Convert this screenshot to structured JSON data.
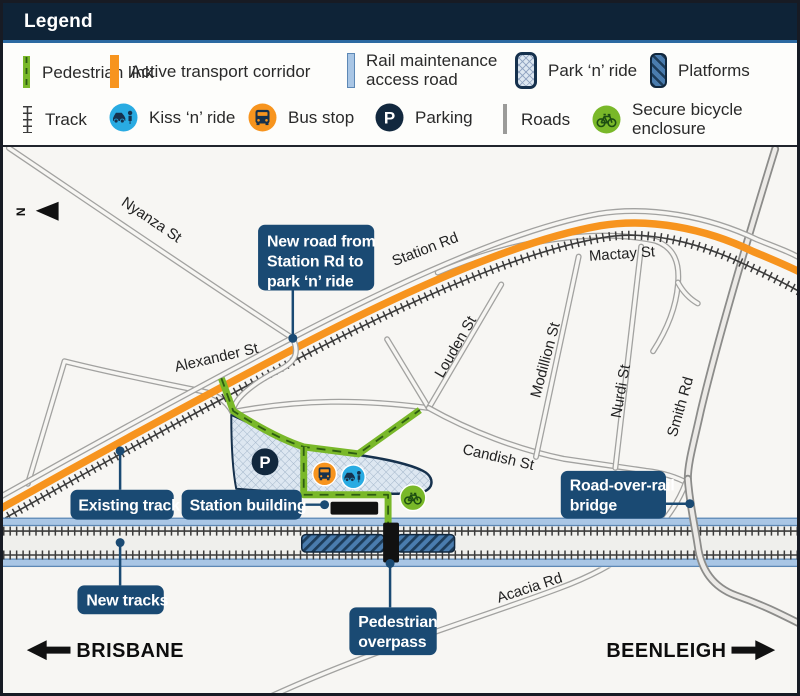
{
  "legend": {
    "title": "Legend",
    "row1": [
      {
        "icon": "pedestrian-link-swatch",
        "label": "Pedestrian link"
      },
      {
        "icon": "active-transport-corridor-swatch",
        "label": "Active transport corridor"
      },
      {
        "icon": "rail-maintenance-road-swatch",
        "lines": [
          "Rail maintenance",
          "access road"
        ]
      },
      {
        "icon": "park-n-ride-swatch",
        "label": "Park ‘n’ ride"
      },
      {
        "icon": "platforms-swatch",
        "label": "Platforms"
      }
    ],
    "row2": [
      {
        "icon": "track-glyph",
        "label": "Track"
      },
      {
        "icon": "kiss-n-ride-icon",
        "label": "Kiss ‘n’ ride"
      },
      {
        "icon": "bus-stop-icon",
        "label": "Bus stop"
      },
      {
        "icon": "parking-icon",
        "label": "Parking"
      },
      {
        "icon": "roads-glyph",
        "label": "Roads"
      },
      {
        "icon": "bicycle-icon",
        "lines": [
          "Secure bicycle",
          "enclosure"
        ]
      }
    ]
  },
  "map": {
    "north_label": "N",
    "parking_symbol": "P",
    "streets": {
      "nyanza": "Nyanza St",
      "alexander": "Alexander St",
      "station_rd": "Station Rd",
      "mactay": "Mactay St",
      "louden": "Louden St",
      "modillion": "Modillion St",
      "nurdi": "Nurdi St",
      "smith": "Smith Rd",
      "candish": "Candish St",
      "acacia": "Acacia Rd"
    },
    "callouts": {
      "new_road": {
        "lines": [
          "New road from",
          "Station Rd to",
          "park ‘n’ ride"
        ]
      },
      "existing_track": {
        "lines": [
          "Existing track"
        ]
      },
      "station_building": {
        "lines": [
          "Station building"
        ]
      },
      "new_tracks": {
        "lines": [
          "New tracks"
        ]
      },
      "pedestrian_overpass": {
        "lines": [
          "Pedestrian",
          "overpass"
        ]
      },
      "road_over_rail": {
        "lines": [
          "Road-over-rail",
          "bridge"
        ]
      }
    },
    "directions": {
      "west": "BRISBANE",
      "east": "BEENLEIGH"
    }
  },
  "colors": {
    "header_navy": "#0e2337",
    "callout_navy": "#1a4a73",
    "icon_navy": "#16314d",
    "orange": "#f7941e",
    "green": "#79b829",
    "kiss_blue": "#29abe2",
    "rail_band_blue": "#a9c6e5",
    "platform_blue": "#4a7cae"
  }
}
